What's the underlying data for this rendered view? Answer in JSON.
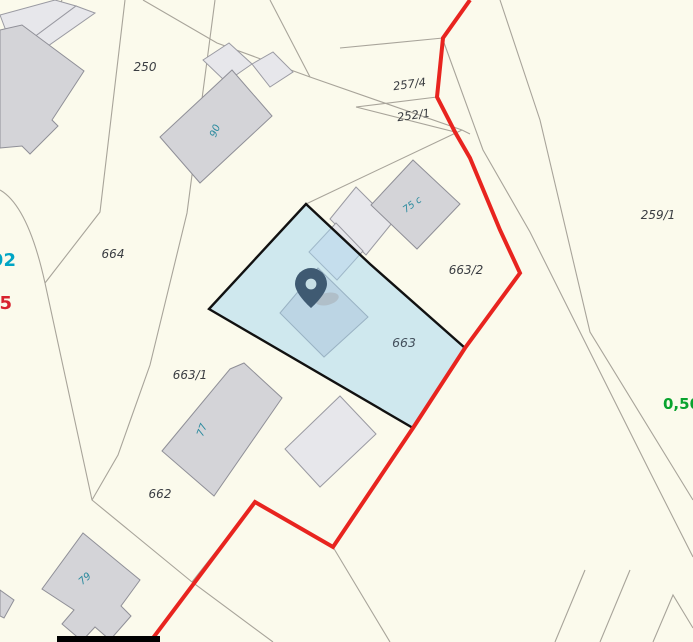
{
  "app": {
    "type": "cadastral-map-viewer",
    "description": "Web-GIS parcel map with selected parcel highlighted and location marker"
  },
  "colors": {
    "background": "#fbfaec",
    "parcel_line": "#a8a49a",
    "building_fill": "#d4d4d8",
    "building_light_fill": "#e7e7eb",
    "highlight_fill": "rgba(163,214,240,0.5)",
    "highlight_outline": "#111111",
    "boundary_red": "#e8241f",
    "pin_fill": "#3f5a72",
    "pin_hole": "#c7dfe5",
    "label_dark": "#3a3d42",
    "label_parcel_663": "#44505c",
    "label_teal": "#2a8a9e",
    "label_cyan": "#00a5c5",
    "label_red": "#d8232f",
    "label_green": "#09a32f",
    "scalebar": "#000000"
  },
  "selected_parcel": {
    "number": "663",
    "highlighted": true,
    "marker": "location-pin"
  },
  "labels": {
    "parcels": [
      {
        "text": "250",
        "x": 145,
        "y": 71,
        "size": 12,
        "color": "#3a3d42",
        "rot": 0
      },
      {
        "text": "257/4",
        "x": 410,
        "y": 88,
        "size": 11.5,
        "color": "#3a3d42",
        "rot": -8
      },
      {
        "text": "252/1",
        "x": 414,
        "y": 119,
        "size": 11.5,
        "color": "#3a3d42",
        "rot": -8
      },
      {
        "text": "259/1",
        "x": 658,
        "y": 219,
        "size": 12,
        "color": "#3a3d42",
        "rot": 0
      },
      {
        "text": "664",
        "x": 113,
        "y": 258,
        "size": 12,
        "color": "#3a3d42",
        "rot": 0
      },
      {
        "text": "663/2",
        "x": 466,
        "y": 274,
        "size": 12,
        "color": "#3a3d42",
        "rot": 0
      },
      {
        "text": "663",
        "x": 404,
        "y": 347,
        "size": 12.5,
        "color": "#44505c",
        "rot": 0
      },
      {
        "text": "663/1",
        "x": 190,
        "y": 379,
        "size": 12,
        "color": "#3a3d42",
        "rot": 0
      },
      {
        "text": "662",
        "x": 160,
        "y": 498,
        "size": 12,
        "color": "#3a3d42",
        "rot": 0
      }
    ],
    "buildings": [
      {
        "text": "90",
        "x": 218,
        "y": 132,
        "size": 10,
        "color": "#2a8a9e",
        "rot": -68
      },
      {
        "text": "75 c",
        "x": 414,
        "y": 207,
        "size": 9.5,
        "color": "#2a8a9e",
        "rot": -36
      },
      {
        "text": "77",
        "x": 205,
        "y": 431,
        "size": 10,
        "color": "#2a8a9e",
        "rot": -70
      },
      {
        "text": "79",
        "x": 87,
        "y": 581,
        "size": 10,
        "color": "#2a8a9e",
        "rot": -42
      }
    ],
    "edge": [
      {
        "text": "92",
        "x": 16,
        "y": 266,
        "size": 18,
        "color": "#00a5c5",
        "bold": true,
        "anchor": "end"
      },
      {
        "text": "75",
        "x": 12,
        "y": 309,
        "size": 18,
        "color": "#d8232f",
        "bold": true,
        "anchor": "end"
      },
      {
        "text": "0,50",
        "x": 663,
        "y": 409,
        "size": 15,
        "color": "#09a32f",
        "bold": true,
        "anchor": "start"
      }
    ]
  }
}
